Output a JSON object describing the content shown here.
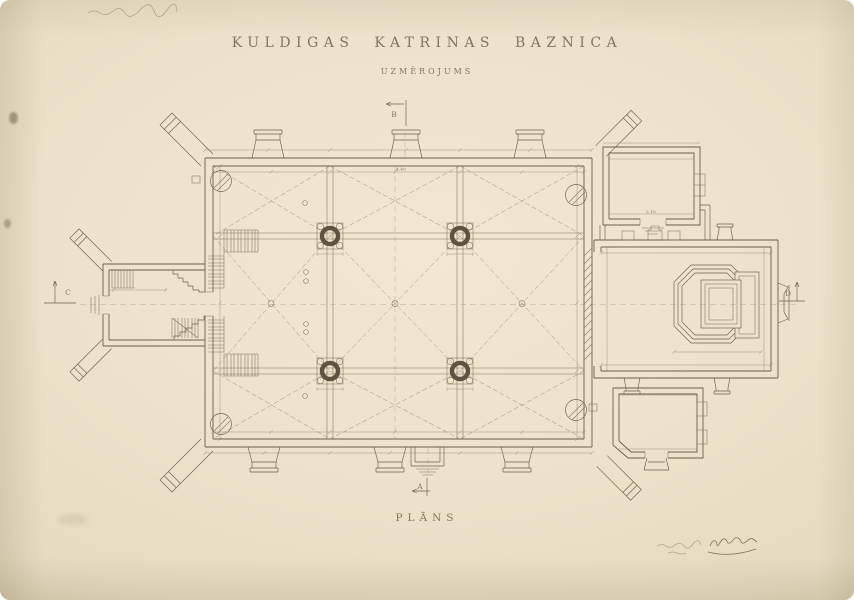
{
  "document": {
    "title": "KULDIGAS KATRINAS BAZNICA",
    "subtitle": "UZMĒROJUMS",
    "caption": "PLĀNS"
  },
  "section_markers": {
    "a": "A",
    "b": "B",
    "c": "C",
    "d": "D"
  },
  "dimensions": {
    "bay_width": "4.40",
    "sacristy_door": "2.10"
  },
  "colors": {
    "paper": "#ece2c9",
    "paper_edge": "#dcd0b4",
    "ink": "#6b5e4b",
    "ink_light": "#8d8069",
    "lettering": "#85755e"
  }
}
